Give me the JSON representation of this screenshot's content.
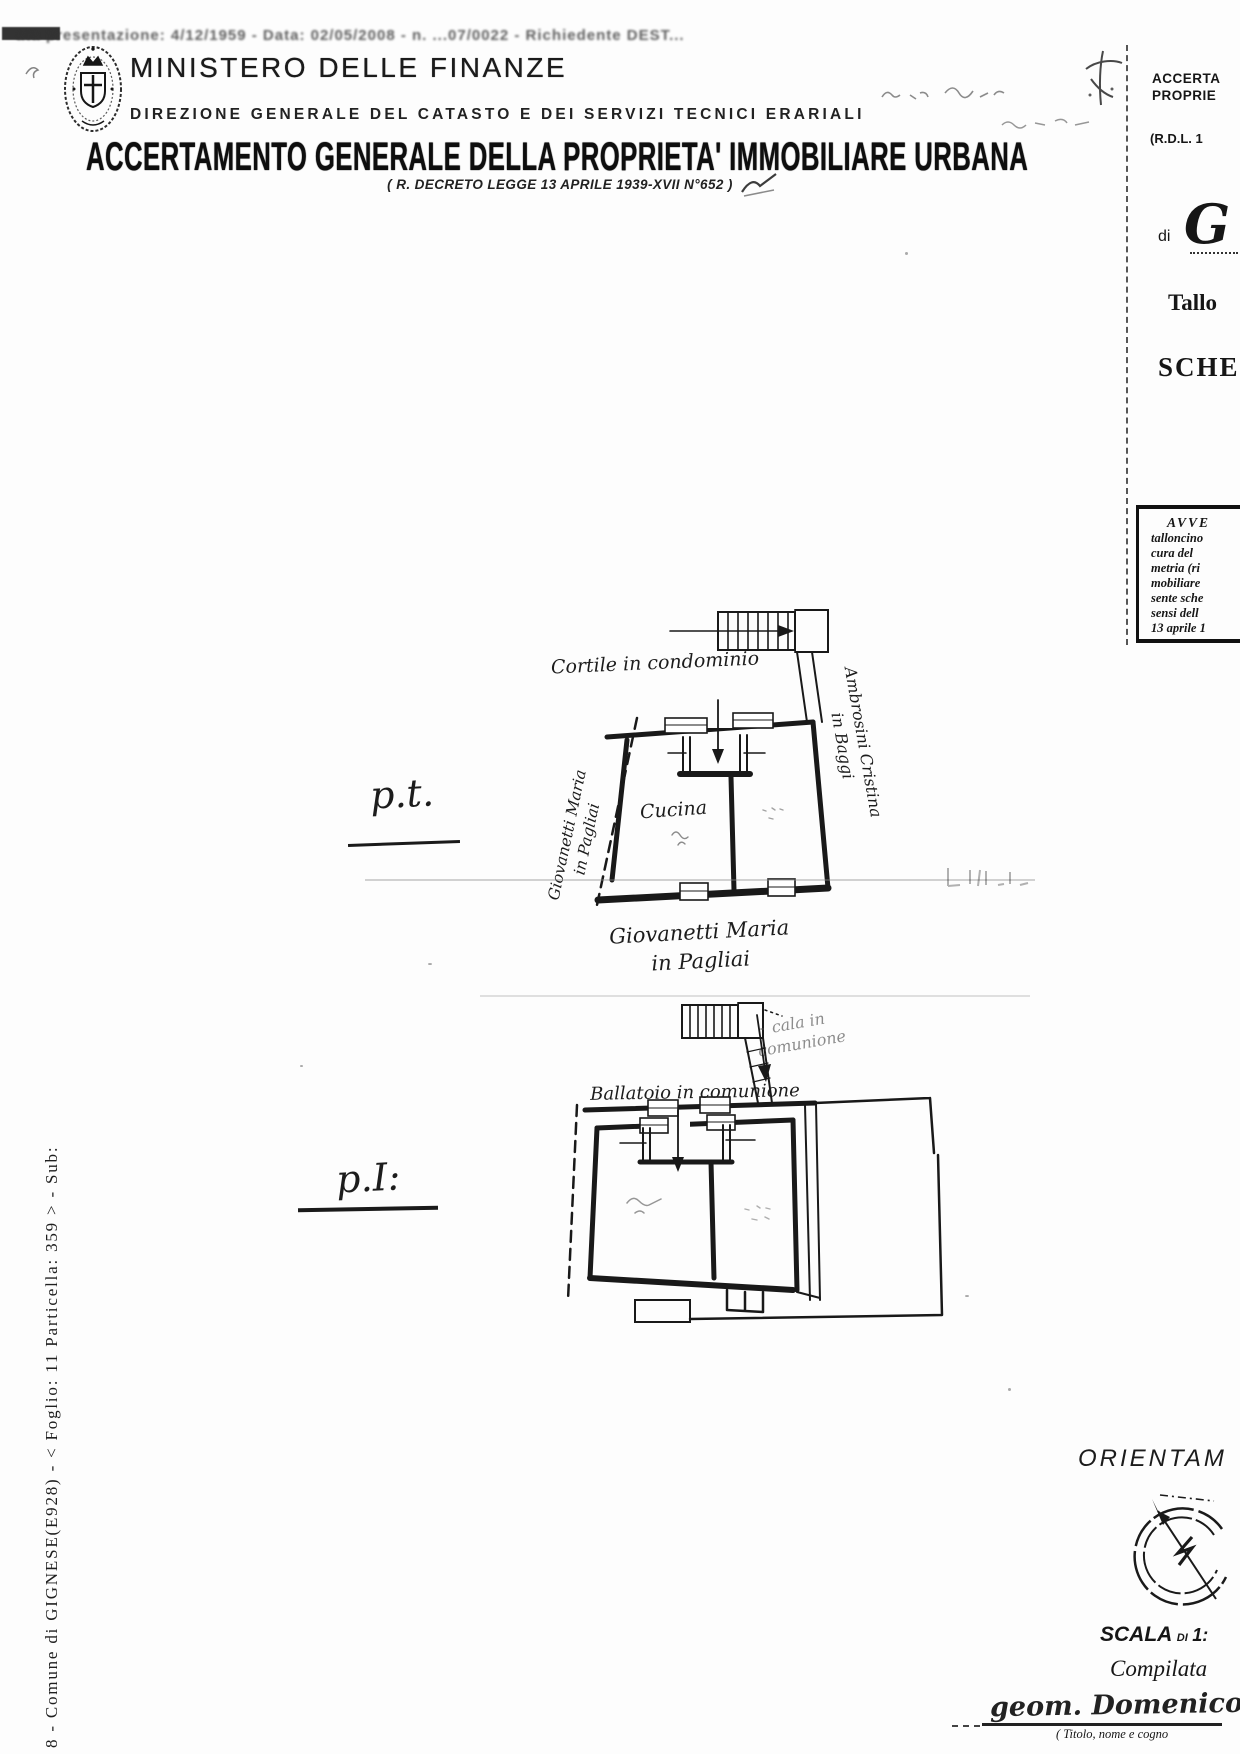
{
  "scan": {
    "top_line": "ata presentazione: 4/12/1959 - Data: 02/05/2008 - n. ...07/0022 - Richiedente DEST..."
  },
  "header": {
    "ministry": "MINISTERO DELLE FINANZE",
    "direction": "DIREZIONE GENERALE DEL CATASTO E DEI SERVIZI TECNICI ERARIALI",
    "title": "ACCERTAMENTO GENERALE DELLA PROPRIETA' IMMOBILIARE URBANA",
    "subtitle": "( R. DECRETO LEGGE 13 APRILE 1939-XVII N°652 )"
  },
  "right_column": {
    "header_line1": "ACCERTA",
    "header_line2": "PROPRIE",
    "law_ref": "(R.D.L. 1",
    "di_label": "di",
    "municipality_initial": "G",
    "talloncino_label": "Tallo",
    "scheda_label": "SCHE",
    "notice_title": "AVVE",
    "notice_lines": [
      "talloncino",
      "cura del",
      "metria (ri",
      "mobiliare",
      "sente sche",
      "sensi dell",
      "13 aprile 1"
    ]
  },
  "ground_floor": {
    "floor_label": "p.t.",
    "courtyard_label": "Cortile in condominio",
    "left_owner_line1": "Giovanetti Maria",
    "left_owner_line2": "in Pagliai",
    "right_owner_line1": "Ambrosini Cristina",
    "right_owner_line2": "in Baggi",
    "room_label": "Cucina",
    "bottom_owner_line1": "Giovanetti Maria",
    "bottom_owner_line2": "in Pagliai"
  },
  "first_floor": {
    "floor_label": "p.I:",
    "stair_label_line1": "cala in",
    "stair_label_line2": "comunione",
    "balcony_label": "Ballatoio in comunione"
  },
  "left_margin": {
    "reference_text": "8 - Comune di GIGNESE(E928) - < Foglio: 11 Particella: 359 > - Sub:"
  },
  "footer": {
    "orientation_label": "ORIENTAM",
    "scale_word": "SCALA",
    "scale_di": "DI",
    "scale_ratio": "1:",
    "compiled_label": "Compilata",
    "signature": "geom. Domenico",
    "signature_caption": "( Titolo, nome e cogno"
  }
}
